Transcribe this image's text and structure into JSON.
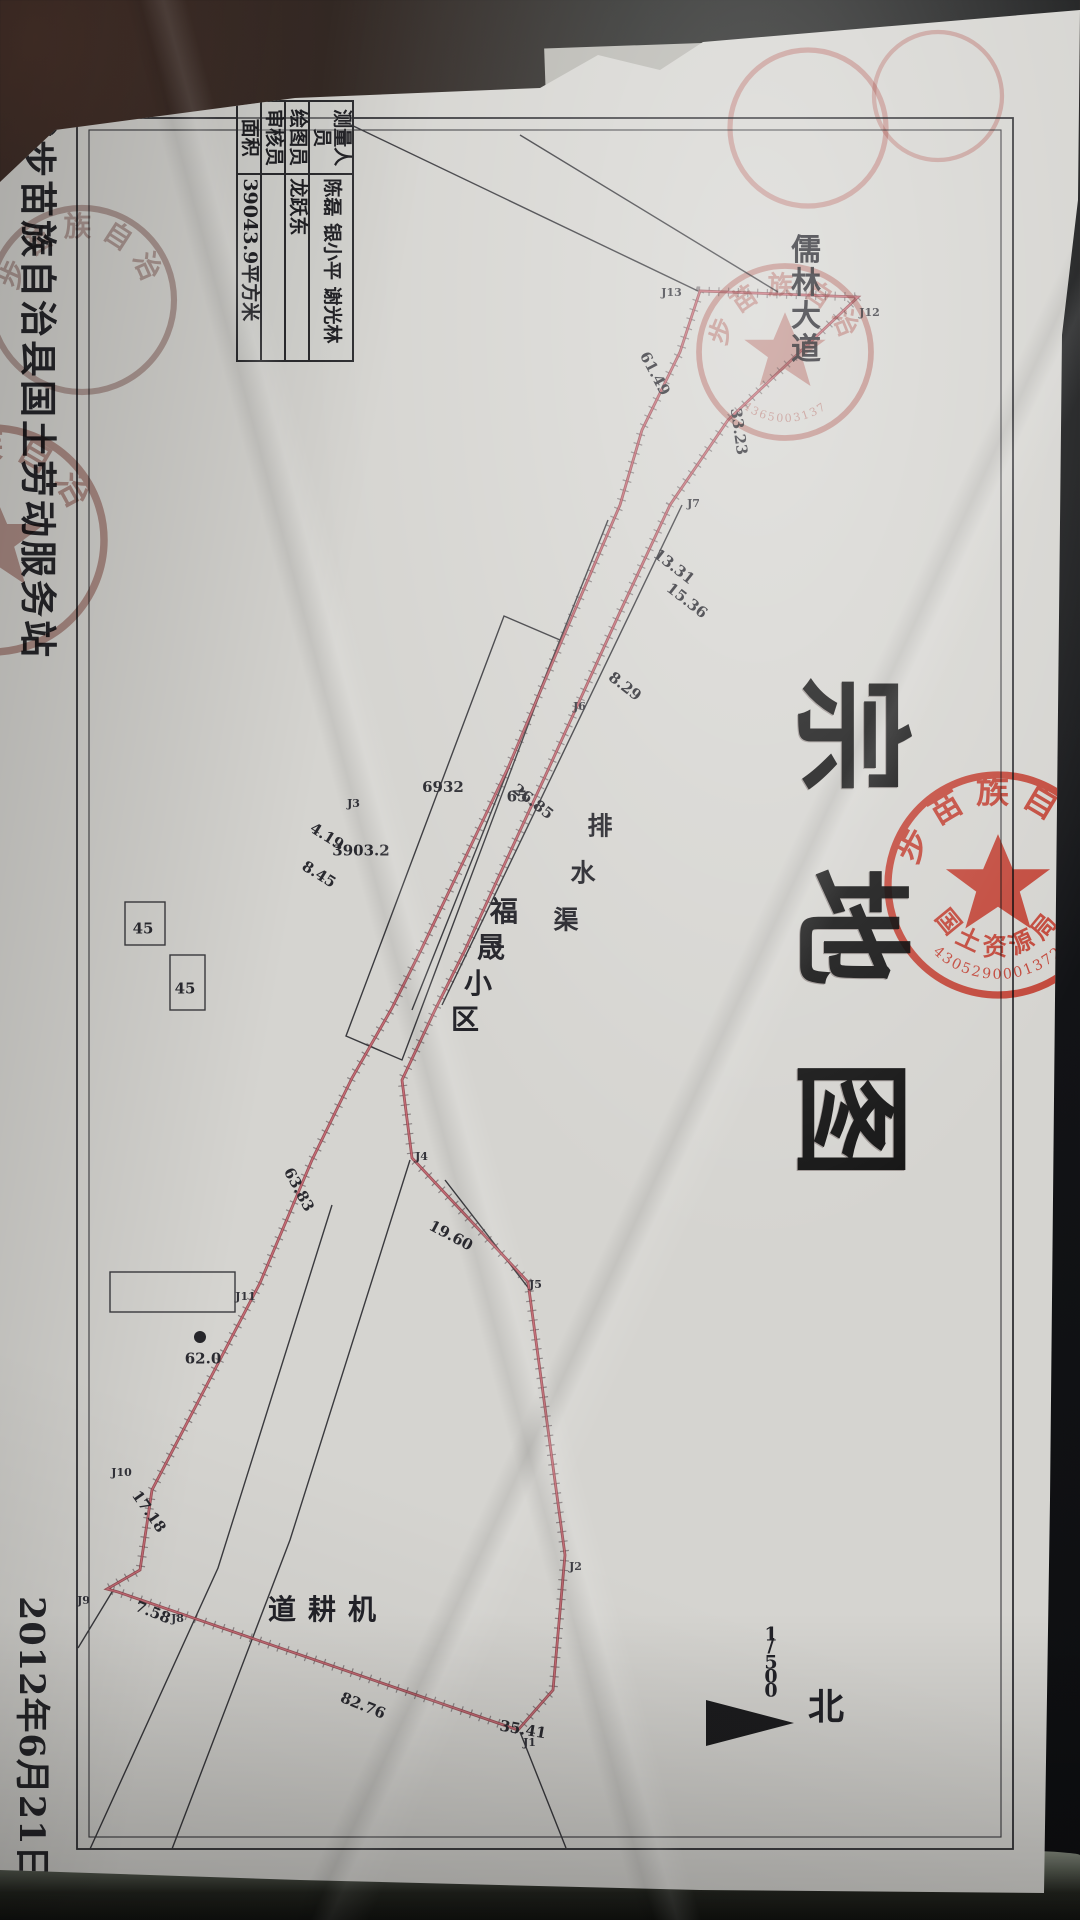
{
  "colors": {
    "paper": "#d5d4d0",
    "seal_red": "#c0392b",
    "boundary_red": "#8c3b42",
    "ink": "#26262a"
  },
  "document": {
    "title": "宗地图",
    "org_footer": "城步苗族自治县国土劳动服务站",
    "date": "2012年6月21日",
    "north_label": "北",
    "scale": "1/500",
    "table": {
      "rows": [
        {
          "label": "测量人员",
          "value": "陈磊 银小平 谢光林"
        },
        {
          "label": "绘图员",
          "value": "龙跃东"
        },
        {
          "label": "审核员",
          "value": ""
        },
        {
          "label": "面积",
          "value": "39043.9平方米"
        }
      ]
    },
    "map_labels": [
      {
        "text": "儒林大道",
        "x": 232,
        "y": 252,
        "dx": 33,
        "dy": 0,
        "fs": 30
      },
      {
        "text": "排水渠",
        "x": 812,
        "y": 462,
        "dx": 47,
        "dy": 17,
        "fs": 25
      },
      {
        "text": "福晟小区",
        "x": 896,
        "y": 556,
        "dx": 36,
        "dy": 13,
        "fs": 28
      },
      {
        "text": "机耕道",
        "x": 1594,
        "y": 698,
        "dx": 0,
        "dy": 40,
        "fs": 28
      },
      {
        "text": "北",
        "x": 1686,
        "y": 228,
        "dx": 0,
        "dy": 0,
        "fs": 36
      },
      {
        "text": "1/500",
        "x": 1628,
        "y": 298,
        "dx": 14,
        "dy": 0,
        "fs": 19
      }
    ],
    "measurements": [
      {
        "t": "33.23",
        "x": 408,
        "y": 332,
        "r": -8
      },
      {
        "t": "61.49",
        "x": 350,
        "y": 416,
        "r": -28
      },
      {
        "t": "13.31",
        "x": 543,
        "y": 397,
        "r": -52
      },
      {
        "t": "15.36",
        "x": 577,
        "y": 384,
        "r": -52
      },
      {
        "t": "8.29",
        "x": 668,
        "y": 446,
        "r": -52
      },
      {
        "t": "26.85",
        "x": 778,
        "y": 538,
        "r": -52
      },
      {
        "t": "4.19",
        "x": 818,
        "y": 744,
        "r": -58
      },
      {
        "t": "8.45",
        "x": 856,
        "y": 752,
        "r": -58
      },
      {
        "t": "3903.2",
        "x": 822,
        "y": 710,
        "r": -90
      },
      {
        "t": "6932",
        "x": 766,
        "y": 628,
        "r": -90
      },
      {
        "t": "65",
        "x": 786,
        "y": 554,
        "r": -90
      },
      {
        "t": "63.83",
        "x": 1166,
        "y": 772,
        "r": -28
      },
      {
        "t": "19.60",
        "x": 1212,
        "y": 620,
        "r": -62
      },
      {
        "t": "62.0",
        "x": 1340,
        "y": 868,
        "r": -90
      },
      {
        "t": "17.18",
        "x": 1488,
        "y": 922,
        "r": -35
      },
      {
        "t": "7.58",
        "x": 1594,
        "y": 918,
        "r": -68
      },
      {
        "t": "82.76",
        "x": 1682,
        "y": 708,
        "r": -68
      },
      {
        "t": "35.41",
        "x": 1706,
        "y": 548,
        "r": -80
      },
      {
        "t": "45",
        "x": 918,
        "y": 928,
        "r": -90
      },
      {
        "t": "45",
        "x": 978,
        "y": 886,
        "r": -90
      }
    ],
    "vertices": [
      {
        "t": "J12",
        "x": 302,
        "y": 204
      },
      {
        "t": "J13",
        "x": 282,
        "y": 402
      },
      {
        "t": "J7",
        "x": 497,
        "y": 380
      },
      {
        "t": "J6",
        "x": 700,
        "y": 494
      },
      {
        "t": "J3",
        "x": 797,
        "y": 720
      },
      {
        "t": "J4",
        "x": 1150,
        "y": 652
      },
      {
        "t": "J5",
        "x": 1278,
        "y": 538
      },
      {
        "t": "J2",
        "x": 1560,
        "y": 498
      },
      {
        "t": "J1",
        "x": 1736,
        "y": 544
      },
      {
        "t": "J11",
        "x": 1286,
        "y": 828
      },
      {
        "t": "J10",
        "x": 1462,
        "y": 952
      },
      {
        "t": "J9",
        "x": 1594,
        "y": 990
      },
      {
        "t": "J8",
        "x": 1612,
        "y": 896
      }
    ],
    "seals": [
      {
        "name": "county-land-seal-large",
        "cx": 885,
        "cy": 82,
        "r": 110,
        "color": "#c0392b",
        "op": 0.9,
        "star": true,
        "top": "城步苗族自治县",
        "bottom": "国土资源局",
        "digits": "4305290001372"
      },
      {
        "name": "map-area-seal",
        "cx": 352,
        "cy": 295,
        "r": 86,
        "color": "#a84840",
        "op": 0.5,
        "star": true,
        "top": "城步苗族自治县",
        "bottom": "",
        "digits": "4365003137"
      },
      {
        "name": "edge-seal-fragment-a",
        "cx": 128,
        "cy": 272,
        "r": 78,
        "color": "#b04a42",
        "op": 0.42,
        "star": false,
        "top": "",
        "bottom": "",
        "digits": ""
      },
      {
        "name": "edge-seal-fragment-b",
        "cx": 96,
        "cy": 142,
        "r": 64,
        "color": "#ad4a42",
        "op": 0.38,
        "star": false,
        "top": "",
        "bottom": "",
        "digits": ""
      },
      {
        "name": "footer-seal",
        "cx": 540,
        "cy": 1088,
        "r": 112,
        "color": "#7d4036",
        "op": 0.5,
        "star": true,
        "top": "城步苗族自治县",
        "bottom": "",
        "digits": ""
      },
      {
        "name": "table-seal",
        "cx": 300,
        "cy": 998,
        "r": 92,
        "color": "#6f4038",
        "op": 0.42,
        "star": false,
        "top": "城步苗族自治县",
        "bottom": "",
        "digits": ""
      }
    ]
  }
}
